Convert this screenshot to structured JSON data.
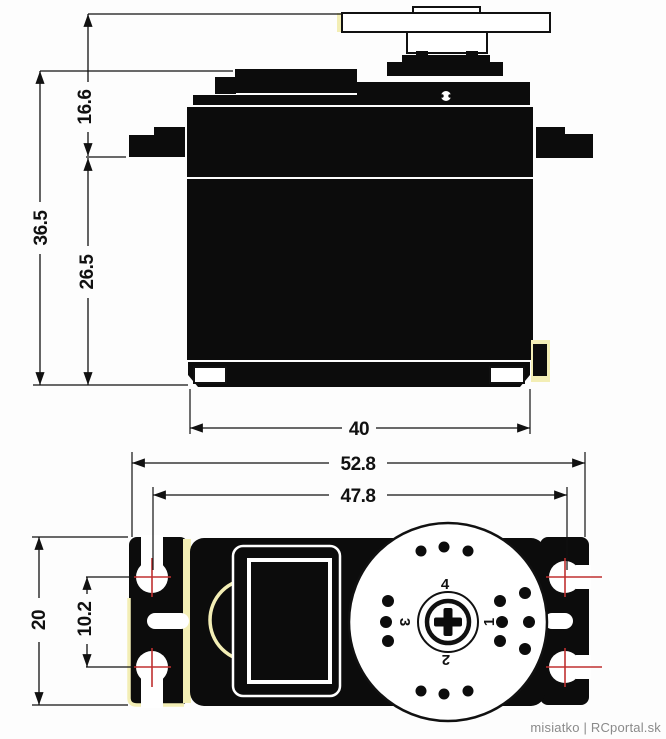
{
  "watermark": "misiatko | RCportal.sk",
  "colors": {
    "ink": "#111111",
    "centerline_red": "#c03030",
    "cream_accent": "#f3eeb5",
    "watermark_gray": "#8a8a8a"
  },
  "side_view": {
    "name": "servo side elevation",
    "dims": {
      "horn_to_mount_tab": "16.6",
      "overall_height": "36.5",
      "tab_to_bottom": "26.5",
      "body_width": "40"
    }
  },
  "bottom_view": {
    "name": "servo top/bottom view",
    "dims": {
      "overall_flange_width": "52.8",
      "mount_hole_span": "47.8",
      "body_depth": "20",
      "mount_hole_pitch": "10.2"
    },
    "horn_numbers": [
      "1",
      "2",
      "3",
      "4"
    ]
  }
}
